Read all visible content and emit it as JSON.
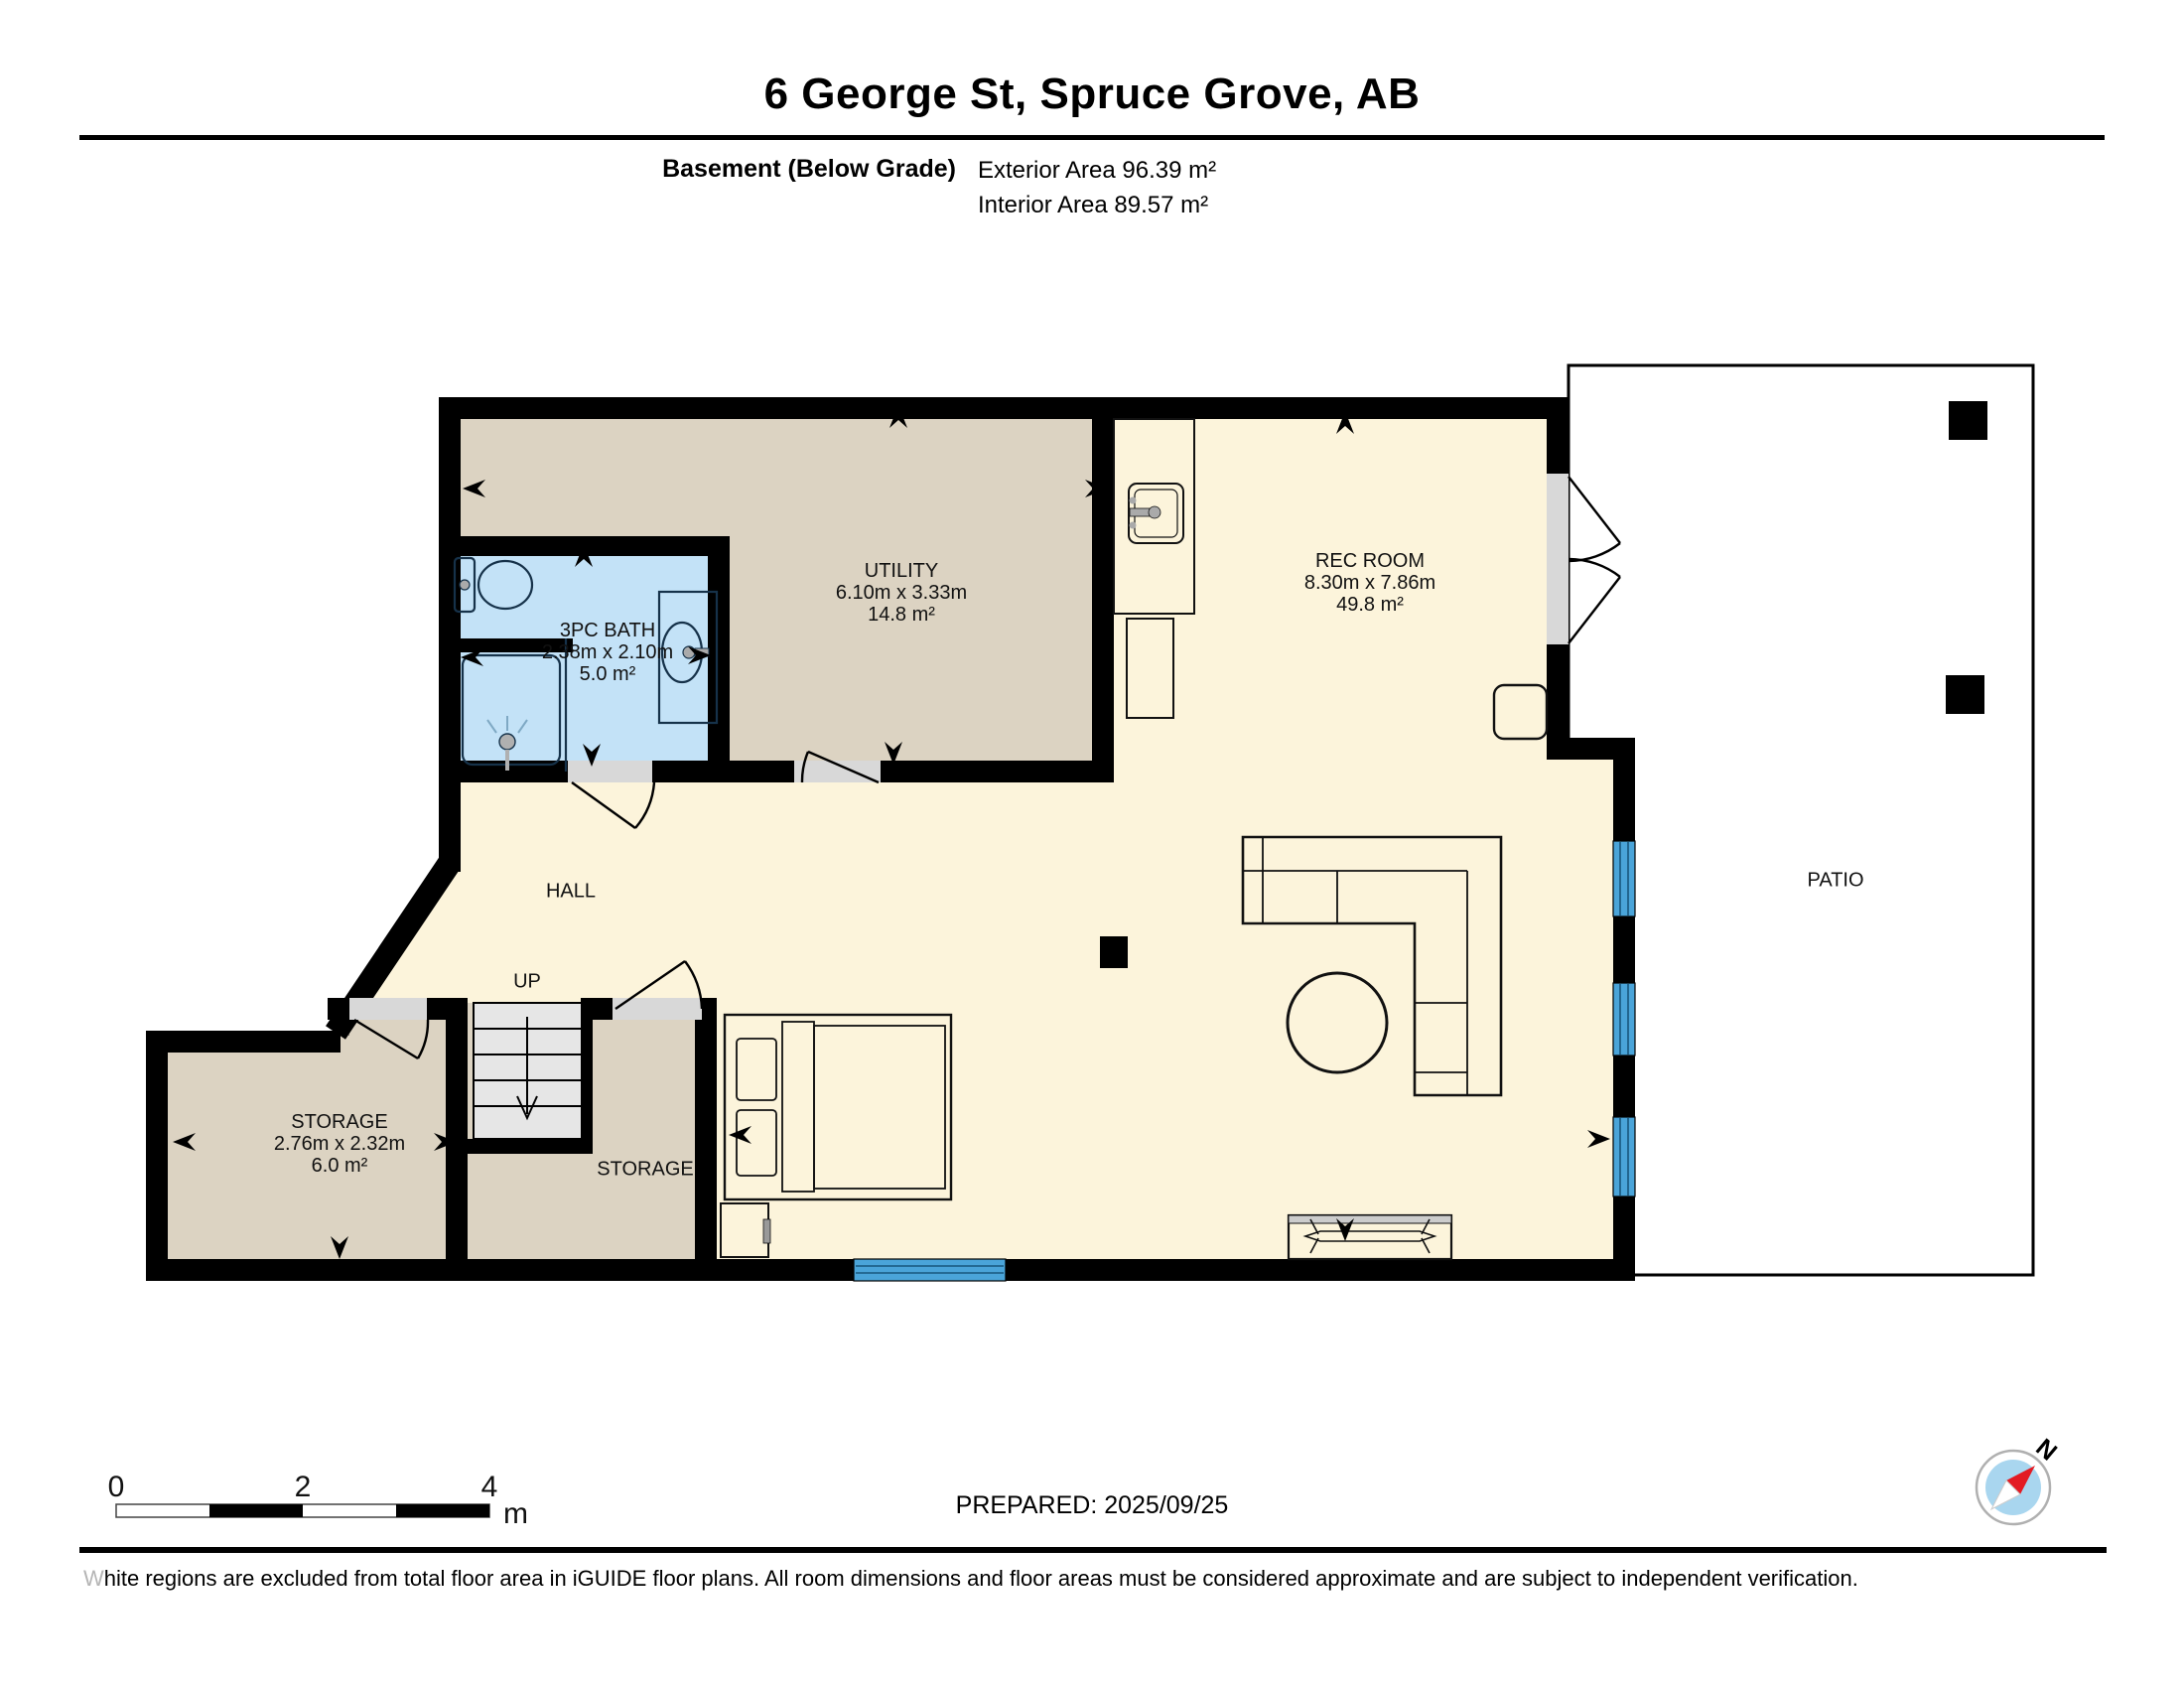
{
  "header": {
    "title": "6 George St, Spruce Grove, AB",
    "floor_label": "Basement (Below Grade)",
    "exterior_area": "Exterior Area 96.39 m²",
    "interior_area": "Interior Area 89.57 m²"
  },
  "rooms": {
    "utility": {
      "name": "UTILITY",
      "dims": "6.10m x 3.33m",
      "area": "14.8 m²"
    },
    "rec_room": {
      "name": "REC ROOM",
      "dims": "8.30m x 7.86m",
      "area": "49.8 m²"
    },
    "bath": {
      "name": "3PC BATH",
      "dims": "2.38m x 2.10m",
      "area": "5.0 m²"
    },
    "storage_main": {
      "name": "STORAGE",
      "dims": "2.76m x 2.32m",
      "area": "6.0 m²"
    },
    "storage_under_stairs": {
      "name": "STORAGE"
    },
    "hall": {
      "name": "HALL"
    },
    "patio": {
      "name": "PATIO"
    },
    "stairs": {
      "up_label": "UP"
    }
  },
  "scale_bar": {
    "tick_0": "0",
    "tick_2": "2",
    "tick_4": "4",
    "unit": "m"
  },
  "compass": {
    "north_label": "N"
  },
  "footer": {
    "prepared": "PREPARED: 2025/09/25",
    "disclaimer": "White regions are excluded from total floor area in iGUIDE floor plans. All room dimensions and floor areas must be considered approximate and are subject to independent verification."
  },
  "colors": {
    "floor_cream": "#fcf4db",
    "floor_beige": "#dcd3c2",
    "bath_blue": "#c3e2f7",
    "window_blue": "#4aa4d9",
    "window_mullion": "#18577d",
    "wall": "#000000",
    "door_opening": "#d8d8d8",
    "stair_tread": "#e6e6e6",
    "compass_face": "#a9d6ef",
    "compass_needle_red": "#e31b23"
  }
}
